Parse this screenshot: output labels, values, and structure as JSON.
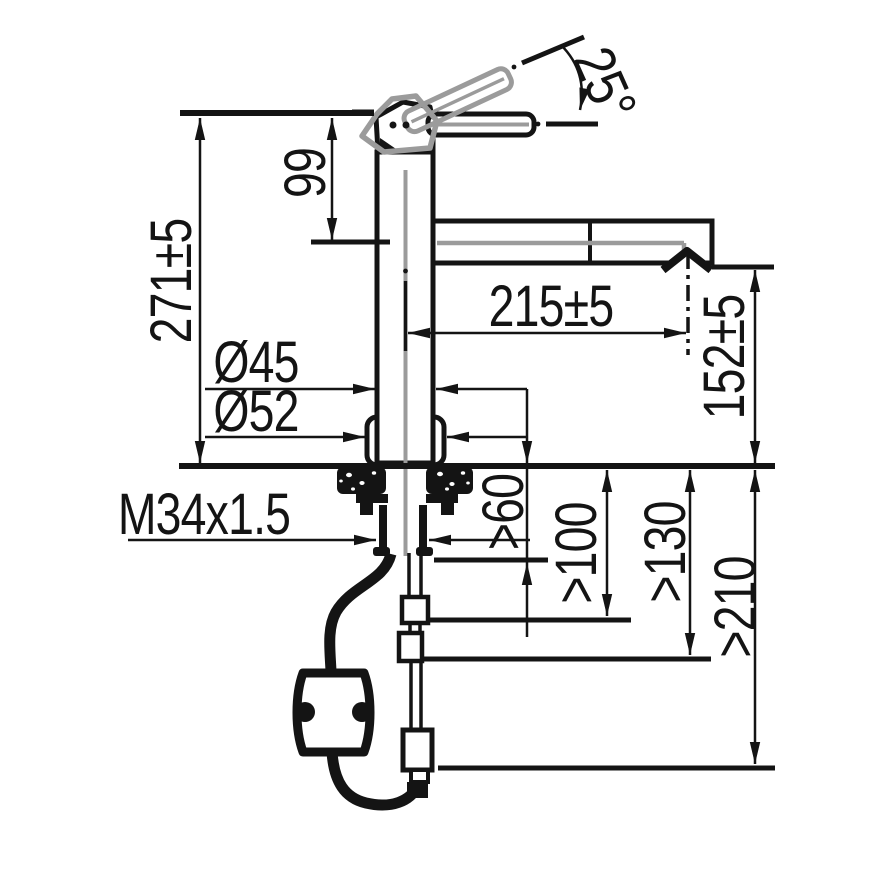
{
  "drawing": {
    "title": "kitchen faucet installation dimension drawing",
    "view": "side elevation with under-counter hose",
    "colors": {
      "line": "#141414",
      "secondary": "#9b9b9b",
      "background": "#ffffff"
    },
    "dimensions": {
      "handle_angle": "25°",
      "head_height": "99",
      "total_height": "271±5",
      "spout_reach": "215±5",
      "outlet_height": "152±5",
      "body_diameter": "Ø45",
      "base_diameter": "Ø52",
      "thread_size": "M34x1.5",
      "clearance_shank": ">60",
      "clearance_hose_upper": ">100",
      "clearance_hose_mid": ">130",
      "clearance_hose_full": ">210"
    }
  }
}
